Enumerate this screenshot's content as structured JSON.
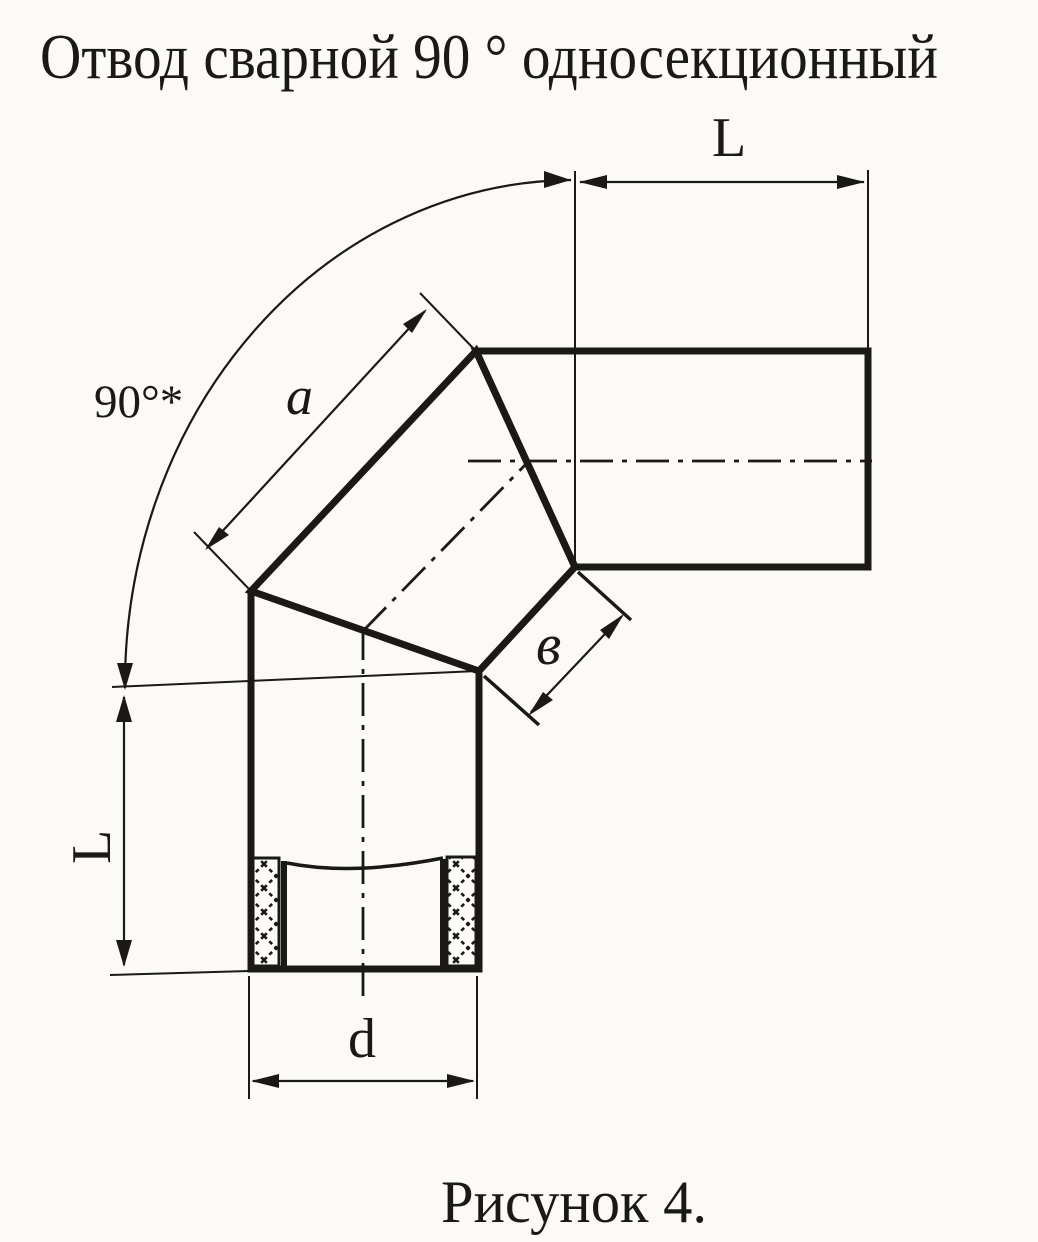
{
  "title": "Отвод сварной 90 ° односекционный",
  "caption": "Рисунок 4.",
  "labels": {
    "angle_mark": "90°*",
    "top_length": "L",
    "left_length": "L",
    "segment_outer_side": "a",
    "segment_inner_side": "в",
    "diameter": "d"
  },
  "colors": {
    "ink": "#1a1917",
    "paper": "#fbfaf7"
  }
}
